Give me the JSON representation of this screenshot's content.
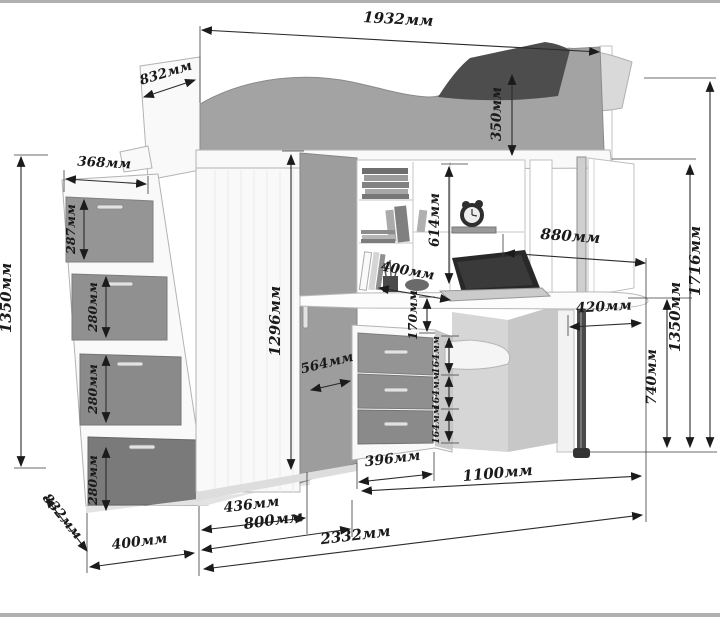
{
  "diagram": {
    "type": "furniture-dimension-diagram",
    "subject": "loft bed with wardrobe, corner desk and stair drawers",
    "unit": "мм"
  },
  "colors": {
    "dimension_text": "#1a1a1a",
    "dimension_line": "#2b2b2b",
    "furniture_white": "#f9f9f9",
    "furniture_gray": "#9d9d9d",
    "blanket_dark": "#4d4d4d"
  },
  "dims": {
    "top_width": "1932мм",
    "top_depth": "832мм",
    "bed_rail_height": "350мм",
    "stairs_top_width": "368мм",
    "stairs_drawer1_height": "287мм",
    "stairs_drawer2_height": "280мм",
    "stairs_drawer3_height": "280мм",
    "stairs_drawer4_height": "280мм",
    "stairs_total_height": "1350мм",
    "bottom_depth": "832мм",
    "stairs_base_width": "400мм",
    "wardrobe_door_width": "436мм",
    "wardrobe_total_width": "800мм",
    "total_width": "2332мм",
    "wardrobe_door_height": "1296мм",
    "wardrobe_angled_side": "564мм",
    "shelf_column_height": "614мм",
    "desk_shelf_depth": "400мм",
    "shelf_to_drawer_gap": "170мм",
    "desk_drawer1_height": "164мм",
    "desk_drawer2_height": "164мм",
    "desk_drawer3_height": "164мм",
    "drawer_unit_width": "396мм",
    "desk_area_width": "1100мм",
    "desktop_width": "880мм",
    "desktop_overhang": "420мм",
    "desktop_height": "740мм",
    "under_bed_height": "1350мм",
    "total_height": "1716мм"
  }
}
